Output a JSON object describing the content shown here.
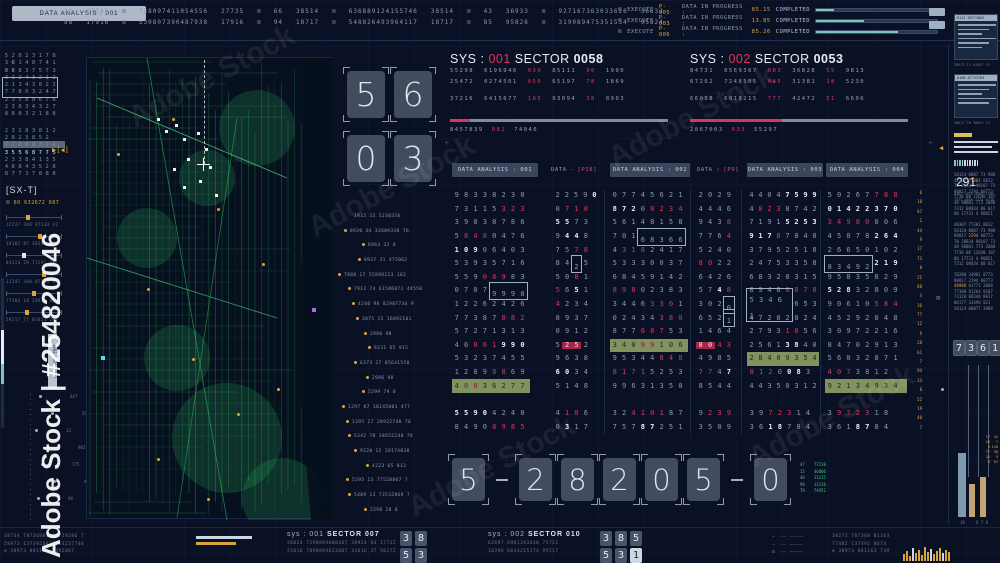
{
  "colors": {
    "bg": "#0a1124",
    "accent_red": "#d9365e",
    "accent_amber": "#d9a43c",
    "accent_teal": "#7ac7bd",
    "map_green": "#2fae5e",
    "text": "#97a3b7",
    "bright": "#e9eef6",
    "olive_highlight": "#7f925f",
    "pink": "#d14a7e"
  },
  "glyphs": {
    "x": "⊠",
    "boxdot": "⊡",
    "marker": "▶[◀]",
    "cross": "+"
  },
  "watermark": {
    "side": "Adobe Stock | #254820046",
    "diag": "Adobe Stock"
  },
  "top_bar": {
    "left_box": "DATA ANALYSIS : 001",
    "rows": [
      [
        "26",
        "27735",
        "⊠",
        "738097411054556",
        "27735",
        "⊠",
        "66",
        "38514",
        "⊠",
        "636889124155746",
        "38514",
        "⊠",
        "43",
        "36933",
        "⊠",
        "927167363033626",
        "36633"
      ],
      [
        "88",
        "17916",
        "⊠",
        "530807390487938",
        "17916",
        "⊠",
        "94",
        "18717",
        "⊠",
        "548826493964117",
        "18717",
        "⊠",
        "85",
        "95826",
        "⊠",
        "319089475351534",
        "95824"
      ]
    ],
    "exec_labels": {
      "exec": "EXECUTE",
      "mid": "DATA IN PROGRESS :",
      "done": "COMPLETED"
    },
    "execs": [
      {
        "code": "P-005",
        "val": "85.15",
        "pct": 15
      },
      {
        "code": "P-003",
        "val": "13.85",
        "pct": 40
      },
      {
        "code": "P-006",
        "val": "85.26",
        "pct": 68
      }
    ]
  },
  "sys_blocks": [
    {
      "prefix": "SYS :",
      "id": "001",
      "sector_label": "SECTOR",
      "sector": "0058",
      "progress": 9,
      "rows": [
        [
          "55298",
          "6196946",
          "030",
          "85111",
          "96",
          "1900"
        ],
        [
          "25472",
          "0274501",
          "050",
          "65197",
          "78",
          "1869"
        ],
        [
          "37216",
          "6415677",
          "185",
          "93094",
          "38",
          "8903"
        ]
      ],
      "footer": [
        "8457839",
        "081",
        "74046"
      ]
    },
    {
      "prefix": "SYS :",
      "id": "002",
      "sector_label": "SECTOR",
      "sector": "0053",
      "progress": 42,
      "rows": [
        [
          "84731",
          "0569367",
          "083",
          "36828",
          "55",
          "9813"
        ],
        [
          "67262",
          "7248505",
          "045",
          "31381",
          "18",
          "5230"
        ],
        [
          "66058",
          "6018215",
          "777",
          "42472",
          "51",
          "6606"
        ]
      ],
      "footer": [
        "2867003",
        "633",
        "55297"
      ]
    }
  ],
  "grid": {
    "headers": [
      {
        "label": "DATA ANALYSIS : 001",
        "boxed": true
      },
      {
        "pre": "DATA -",
        "accent": "[P18]",
        "boxed": false
      },
      {
        "label": "DATA ANALYSIS : 002",
        "boxed": true
      },
      {
        "pre": "DATA :",
        "accent": "[P9]",
        "boxed": false
      },
      {
        "label": "DATA ANALYSIS : 003",
        "boxed": true
      },
      {
        "label": "DATA ANALYSIS : 004",
        "boxed": true
      }
    ],
    "columns": [
      [
        "98338230",
        "73115(323)",
        "39038786",
        "5(848)0476",
        "{109}06403",
        "53935716",
        "559(089)83",
        "0707[9990]",
        "12262426",
        "77387(882)",
        "57271313",
        "46(861){990}",
        "53237455",
        "1289(88)69",
        "*4(00)36277",
        "",
        "{5590}4240",
        "8490(8985)"
      ],
      [
        "2259{0}",
        "0(710)",
        "{55}73",
        "9{44}8",
        "75(78)",
        "84[2]5",
        "50(8)1",
        "(5)6{5}1",
        "(4)234",
        "8937",
        "0912",
        "5<25>2",
        "9638",
        "{60}34",
        "5148",
        "",
        "4(10)6",
        "0{3}17"
      ],
      [
        "07745621",
        "{872}0(8234)",
        "56148158",
        "701[68366]",
        "4(318)2417",
        "53330037",
        "68459142",
        "(898)02383",
        "3446(330)1",
        "02434(380)",
        "877(687)53",
        "*340(99)106",
        "95344(848)",
        "(8171)5253",
        "99631350",
        "",
        "32(4101)87",
        "757{87}251"
      ],
      [
        "2029",
        "4446",
        "943(8)",
        "776(4)",
        "5240",
        "(80)22",
        "6426",
        "57{4}(8)",
        "302[0]",
        "652[1]",
        "1464",
        "<80>(43)",
        "4985",
        "(77)4{7}",
        "8544",
        "",
        "9(239)",
        "3509"
      ],
      [
        "4404{7599}",
        "4(823)8742",
        "7191{5253}",
        "{917}(8)7840",
        "37952518",
        "24753358",
        "68320315",
        "8948(8878)",
        "[53461]653",
        "47282024",
        "2793(18)56",
        "2561{38}40",
        "*28409354",
        "(812)0{08}3",
        "44350312",
        "",
        "39(723)14",
        "36{18}784"
      ],
      [
        "50267(788)",
        "{01422370}",
        "(34980)006",
        "45078{264}",
        "26650102",
        "[83492]{219}",
        "95835829",
        "{528}32809",
        "90610(584)",
        "45292048",
        "30972216",
        "84702913",
        "56032871",
        "(407)3812",
        "*92134934",
        "",
        "3(9723)18",
        "361{87}84"
      ]
    ],
    "micro_column": [
      "6",
      "18",
      "87",
      "2",
      "44",
      "9",
      "17",
      "73",
      "8",
      "21",
      "88",
      "4",
      "36",
      "77",
      "12",
      "9",
      "28",
      "61",
      "7",
      "94",
      "33",
      "8",
      "52",
      "19",
      "40",
      "7"
    ]
  },
  "flip_top": [
    [
      "5",
      "6"
    ],
    [
      "0",
      "3"
    ]
  ],
  "flip_bottom": [
    "5",
    "-",
    "2",
    "8",
    "2",
    "0",
    "5",
    "-",
    "0"
  ],
  "green_cols": {
    "c1": [
      "47",
      "15",
      "46",
      "98",
      "79"
    ],
    "c2": [
      "77210",
      "46806",
      "11115",
      "11116",
      "74952"
    ]
  },
  "map_list": [
    {
      "t": "1915 15 5230356",
      "b": false,
      "ind": 18
    },
    {
      "t": "8920 34 33609338 76",
      "b": true,
      "ind": 8
    },
    {
      "t": "6964 32 8",
      "b": true,
      "ind": 26
    },
    {
      "t": "8937 31 475062",
      "b": true,
      "ind": 22
    },
    {
      "t": "7888 17 55898213 162",
      "b": true,
      "ind": 2
    },
    {
      "t": "7912 74 61586071 44558",
      "b": true,
      "ind": 12
    },
    {
      "t": "4240 98 82987734 9",
      "b": true,
      "ind": 16
    },
    {
      "t": "3075 15 16892101",
      "b": true,
      "ind": 20
    },
    {
      "t": "2980 98",
      "b": true,
      "ind": 28
    },
    {
      "t": "9231 65 915",
      "b": true,
      "ind": 32
    },
    {
      "t": "6373 27 85641550",
      "b": true,
      "ind": 18
    },
    {
      "t": "2986 98",
      "b": true,
      "ind": 30
    },
    {
      "t": "5299 79 8",
      "b": true,
      "ind": 26
    },
    {
      "t": "1297 87 18145001 477",
      "b": true,
      "ind": 6
    },
    {
      "t": "1395 27 28922748 76",
      "b": true,
      "ind": 10
    },
    {
      "t": "5342 78 28652248 78",
      "b": true,
      "ind": 12
    },
    {
      "t": "9228 15 28174038",
      "b": true,
      "ind": 18
    },
    {
      "t": "4223 65 812",
      "b": true,
      "ind": 30
    },
    {
      "t": "5295 13 77528807 7",
      "b": true,
      "ind": 10
    },
    {
      "t": "5489 13 73532869 7",
      "b": true,
      "ind": 12
    },
    {
      "t": "2298 28 8",
      "b": true,
      "ind": 28
    }
  ],
  "leftbar": {
    "grid": [
      "5282«3»178",
      "3{6}14«8»741",
      "{88}83757(3)",
      "31«2»43212",
      "21343«8»22",
      "[77803247]",
      "235«8»8678",
      "23«8»34327",
      "8«8»8321(88)",
      "",
      "232«8»3812",
      "2«8»238«52»",
      "7288(8)324",
      "*35568775",
      "2338«41»35",
      "48«8»43528",
      "8773(7)8«88»"
    ],
    "sx_label": "[SX-T]",
    "sx_sub": "60 632672 687",
    "sliders": [
      {
        "t": "12247 348 87134 42",
        "p": 36,
        "c": "a"
      },
      {
        "t": "39102 87 38240 77",
        "p": 58,
        "c": "a"
      },
      {
        "t": "84113 29 77291 18",
        "p": 28,
        "c": "w"
      },
      {
        "t": "12247 348 87134 42",
        "p": 64,
        "c": "a"
      },
      {
        "t": "77302 18 29914 83",
        "p": 46,
        "c": "a"
      },
      {
        "t": "59217 77 83021 29",
        "p": 34,
        "c": "a"
      }
    ],
    "readout": {
      "bars": [
        34,
        28,
        22,
        30
      ],
      "tag": "5682 0071 3348"
    },
    "nodes": [
      {
        "t": "847",
        "o": 8
      },
      {
        "t": "2986",
        "o": 20
      },
      {
        "t": "13",
        "o": 4
      },
      {
        "t": "9021",
        "o": 16
      },
      {
        "t": "775",
        "o": 10
      },
      {
        "t": "4407",
        "o": 22
      },
      {
        "t": "98",
        "o": 6
      }
    ]
  },
  "bottom_bar": {
    "left_rows": [
      "38734 78736881163729286 7",
      "28973 1373928617 14237746",
      "⊠ 38973 881163 7392867"
    ],
    "sys_footers": [
      {
        "prefix": "sys :",
        "id": "001",
        "sector": "SECTOR 007",
        "rows": [
          "26024 7298894600267 38924 84 17722",
          "25816 7898894622087 32616 37 50272"
        ],
        "flip": [
          [
            "3",
            "8"
          ],
          [
            "5",
            "3"
          ]
        ]
      },
      {
        "prefix": "sys :",
        "id": "002",
        "sector": "SECTOR 010",
        "rows": [
          "62697 6961343636 75721",
          "10396 6643215174 95517"
        ],
        "flip": [
          [
            "3",
            "8",
            "5"
          ],
          [
            "5",
            "3",
            "!1"
          ]
        ]
      }
    ],
    "dash_rows": [
      "– ·– ––––",
      "– ·– ––––",
      "⊡ ·– ––––"
    ],
    "right_rows": [
      "38273 787368 81163",
      "77482 137392 8674",
      "⊠ 38973 881163 739"
    ],
    "hist": {
      "heights": [
        7,
        10,
        5,
        13,
        8,
        11,
        6,
        14,
        9,
        12,
        7,
        10,
        13,
        8,
        11,
        9
      ],
      "light": [
        3,
        9,
        13
      ]
    }
  },
  "right_panel": {
    "windows": [
      {
        "title": "0112 88773802",
        "lines": [
          "88273 0173 88 2017 736",
          "7730 1288 34 8801 7",
          "2884 017 7 73882 0",
          "88 1773 28 834 8",
          "017 7882 0 4417 88",
          "73012 88 34880 17"
        ],
        "cap": "38973 13 62897 74"
      },
      {
        "title": "0108 87733764",
        "lines": [
          "7730 1288 34 8801 7",
          "88273 0173 88 2017",
          "2884 017 7 73882",
          "017 7882 0 4417 88",
          "88 1773 28 834 8"
        ],
        "cap": "28817 70 38824 13"
      }
    ],
    "counter": {
      "value": "291",
      "sub": [
        "8387 2879 0388 1287",
        "7873 0886 2774 6738"
      ]
    },
    "paras": [
      [
        "58124 0887 73 988",
        "48307 «77301» 8812",
        "70 28834 98107 73",
        "88017 2294 60773",
        "7730 88 12648 107",
        "48 98801 773 2088",
        "7312 08834 88 017",
        "80 17733 4 98821"
      ],
      [
        "48307 77301 8812",
        "58124 0887 73 988",
        "88017 «2294» 60773",
        "70 28834 98107 73",
        "48 98801 773 2088",
        "7730 88 12648 107",
        "80 17733 4 98821",
        "7312 08834 88 017"
      ],
      [
        "70288 34981 0773",
        "88017 2294 60773",
        "«48988» 01773 2088",
        "77308 81264 8107",
        "73120 88348 8017",
        "80177 33498 821",
        "58124 08877 3988"
      ]
    ],
    "flip": [
      "7",
      "3",
      "6",
      "1"
    ],
    "chart": {
      "bars": [
        {
          "h": 64,
          "c": "s"
        },
        {
          "h": 33,
          "c": "t"
        },
        {
          "h": 40,
          "c": "t"
        }
      ],
      "cols": [
        [
          "17",
          "28",
          "9",
          "77",
          "31",
          "8"
        ],
        [
          "44",
          "7",
          "120",
          "38",
          "9",
          "61"
        ]
      ],
      "labels": [
        "18",
        "8 7 8"
      ]
    }
  }
}
